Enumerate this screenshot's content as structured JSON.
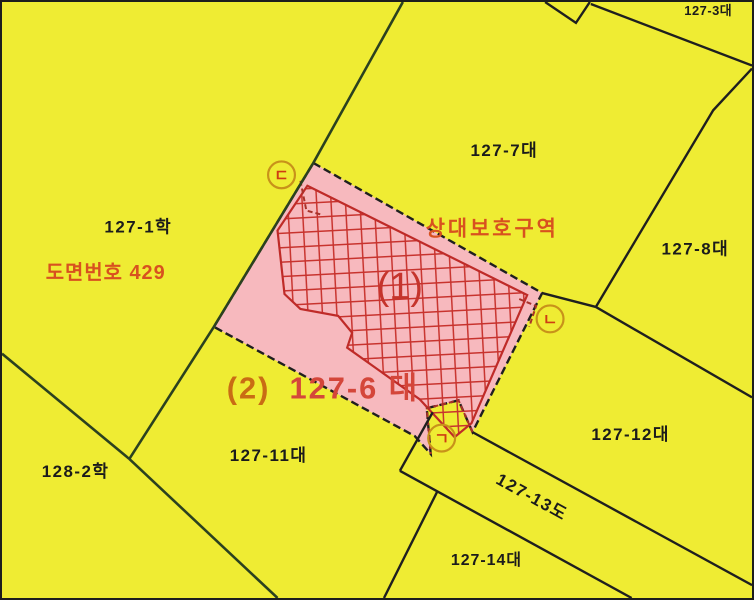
{
  "map": {
    "type": "korean-cadastral-map",
    "colors": {
      "background": "#efec33",
      "parcel_highlight": "#f7b9be",
      "hatch_red": "#c8332e",
      "hatch_outline": "#bf2b28",
      "boundary_dark": "#1f1f1f",
      "boundary_green": "#2b411f",
      "stamp_orange_red": "#d8511f",
      "subject_prefix_color": "#c96c14",
      "subject_lot_color": "#d4463a",
      "marker_ring": "#c8921a",
      "marker_letter": "#cf3d12",
      "building_number_red": "#c5342c",
      "label_black": "#1b1b1b"
    },
    "stamps": {
      "drawing_number": "도면번호 429",
      "zone_name": "상대보호구역",
      "subject_prefix": "(2)",
      "subject_lot": "127-6 대",
      "building_number": "(1)"
    },
    "parcel_labels": {
      "p127_1": "127-1학",
      "p127_3": "127-3대",
      "p127_7": "127-7대",
      "p127_8": "127-8대",
      "p127_11": "127-11대",
      "p127_12": "127-12대",
      "p127_13": "127-13도",
      "p127_14": "127-14대",
      "p128_2": "128-2학"
    },
    "markers": {
      "giyeok": "ㄱ",
      "nieun": "ㄴ",
      "digeut": "ㄷ"
    }
  }
}
